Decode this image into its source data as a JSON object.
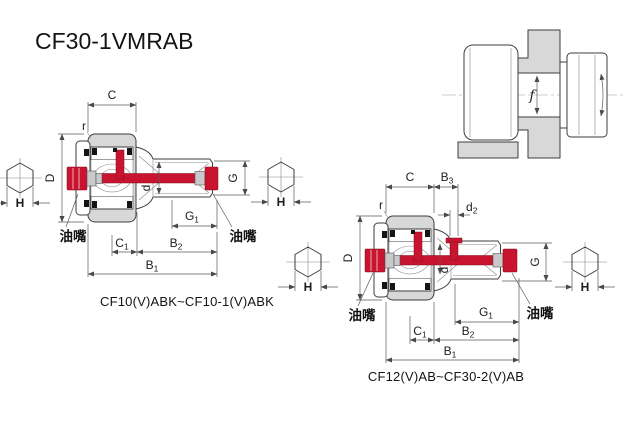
{
  "title": "CF30-1VMRAB",
  "colors": {
    "red": "#c8142e",
    "gray": "#d8d8d8",
    "line": "#3d3d3d"
  },
  "labels": {
    "C": "C",
    "r": "r",
    "D": "D",
    "H": "H",
    "d": "d",
    "G": "G",
    "f": "f",
    "G1": {
      "main": "G",
      "sub": "1"
    },
    "C1": {
      "main": "C",
      "sub": "1"
    },
    "B1": {
      "main": "B",
      "sub": "1"
    },
    "B2": {
      "main": "B",
      "sub": "2"
    },
    "B3": {
      "main": "B",
      "sub": "3"
    },
    "d2": {
      "main": "d",
      "sub": "2"
    },
    "grease_nipple": "油嘴"
  },
  "diagrams": {
    "left_section": {
      "caption": "CF10(V)ABK~CF10-1(V)ABK"
    },
    "right_section": {
      "caption": "CF12(V)AB~CF30-2(V)AB"
    }
  }
}
